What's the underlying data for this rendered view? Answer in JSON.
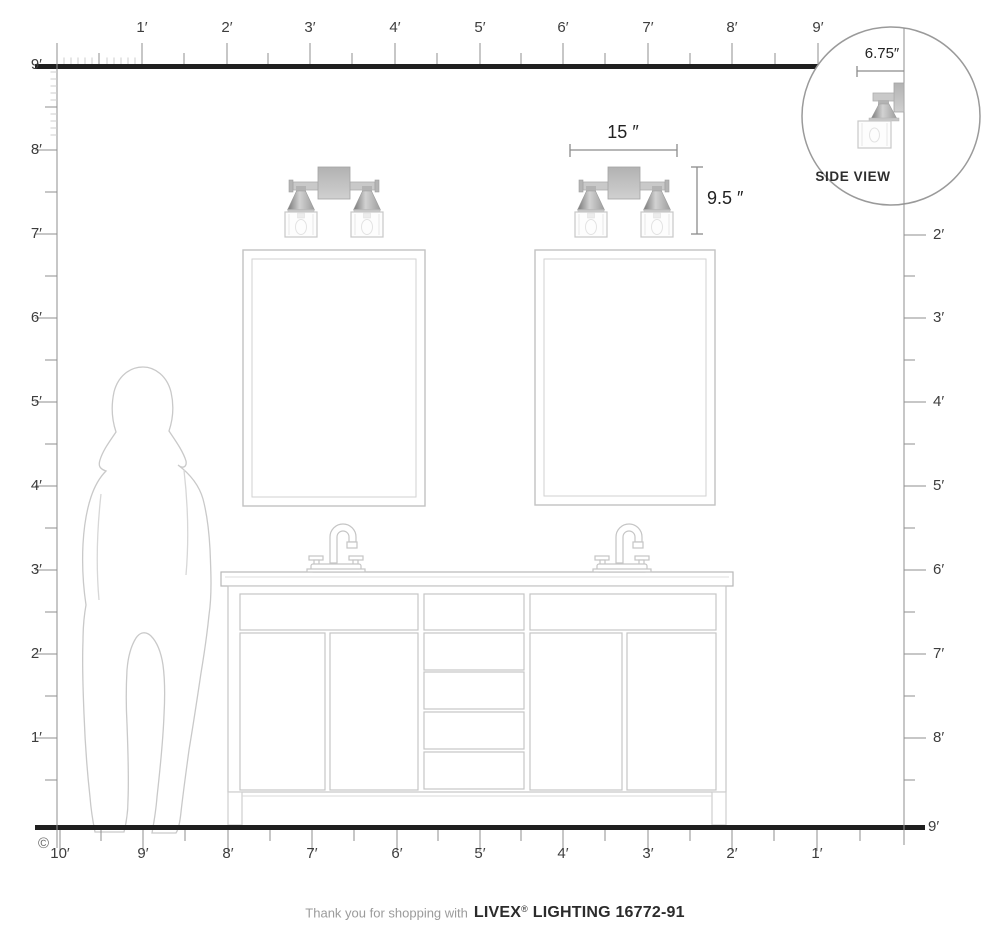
{
  "colors": {
    "background": "#ffffff",
    "heavy_line": "#1f1f1f",
    "ruler_line": "#8f8f8f",
    "fine_tick": "#cdcdcd",
    "label_text": "#3d3d3d",
    "dimension_text": "#222222",
    "drawing_line": "#c6c6c6",
    "metal_gray": "#b9b9b9",
    "footer_gray": "#9b9b9b",
    "footer_dark": "#2b2b2b"
  },
  "rulers": {
    "top": {
      "labels": [
        "1′",
        "2′",
        "3′",
        "4′",
        "5′",
        "6′",
        "7′",
        "8′",
        "9′"
      ]
    },
    "left": {
      "labels": [
        "9′",
        "8′",
        "7′",
        "6′",
        "5′",
        "4′",
        "3′",
        "2′",
        "1′"
      ]
    },
    "right": {
      "labels": [
        "2′",
        "3′",
        "4′",
        "5′",
        "6′",
        "7′",
        "8′"
      ],
      "floor_label": "9′"
    },
    "bottom": {
      "labels": [
        "10′",
        "9′",
        "8′",
        "7′",
        "6′",
        "5′",
        "4′",
        "3′",
        "2′",
        "1′"
      ]
    }
  },
  "dimensions": {
    "fixture_width": "15 ″",
    "fixture_height": "9.5 ″",
    "side_projection": "6.75″"
  },
  "inset": {
    "caption": "SIDE VIEW"
  },
  "copyright": "©",
  "footer": {
    "thanks": "Thank you for shopping with",
    "brand": "LIVEX",
    "reg": "®",
    "model": "LIGHTING 16772-91"
  }
}
